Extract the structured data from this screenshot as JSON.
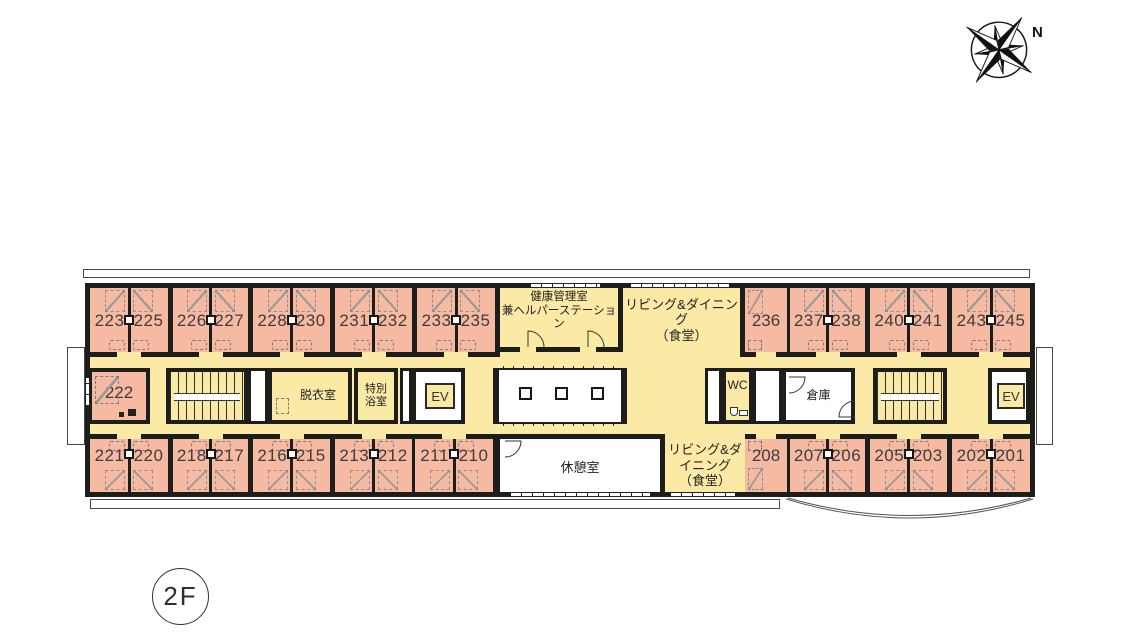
{
  "floor_label": "2F",
  "compass_label": "N",
  "colors": {
    "room_pink": "#f6b9a2",
    "corridor_yellow": "#fbe9a6",
    "wall_black": "#1d1d1b"
  },
  "rooms": {
    "top_pairs": [
      {
        "left": "223",
        "right": "225",
        "x": 5,
        "w": 78
      },
      {
        "left": "226",
        "right": "227",
        "x": 88,
        "w": 75
      },
      {
        "left": "228",
        "right": "230",
        "x": 168,
        "w": 77
      },
      {
        "left": "231",
        "right": "232",
        "x": 250,
        "w": 77
      },
      {
        "left": "233",
        "right": "235",
        "x": 332,
        "w": 78
      },
      {
        "left": "237",
        "right": "238",
        "x": 705,
        "w": 75
      },
      {
        "left": "240",
        "right": "241",
        "x": 785,
        "w": 77
      },
      {
        "left": "243",
        "right": "245",
        "x": 867,
        "w": 78
      }
    ],
    "bottom_pairs": [
      {
        "left": "221",
        "right": "220",
        "x": 5,
        "w": 78
      },
      {
        "left": "218",
        "right": "217",
        "x": 88,
        "w": 75
      },
      {
        "left": "216",
        "right": "215",
        "x": 168,
        "w": 77
      },
      {
        "left": "213",
        "right": "212",
        "x": 250,
        "w": 77
      },
      {
        "left": "211",
        "right": "210",
        "x": 330,
        "w": 78
      },
      {
        "left": "207",
        "right": "206",
        "x": 705,
        "w": 75
      },
      {
        "left": "205",
        "right": "203",
        "x": 785,
        "w": 77
      },
      {
        "left": "202",
        "right": "201",
        "x": 867,
        "w": 78
      }
    ],
    "top_singles": [
      {
        "label": "236",
        "x": 660,
        "w": 42
      }
    ],
    "bottom_singles": [
      {
        "label": "208",
        "x": 660,
        "w": 42
      }
    ],
    "side_room": {
      "label": "222"
    }
  },
  "facilities": {
    "health_room_line1": "健康管理室",
    "health_room_line2": "兼ヘルパーステーション",
    "living_dining_line1": "リビング&ダイニング",
    "living_dining_line2": "（食堂）",
    "rest_room": "休憩室",
    "dressing_room": "脱衣室",
    "special_bath_line1": "特別",
    "special_bath_line2": "浴室",
    "wc": "WC",
    "storage": "倉庫",
    "elevator": "EV"
  }
}
